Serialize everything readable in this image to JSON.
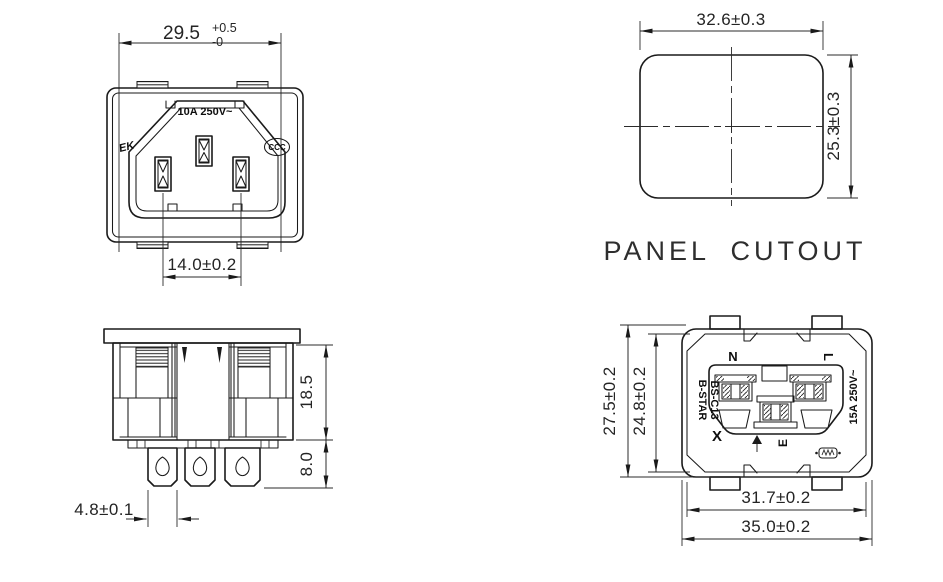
{
  "colors": {
    "line": "#1a1a1a",
    "background": "#ffffff",
    "dim_text": "#242424"
  },
  "front_view": {
    "marking_rating": "10A 250V~",
    "cert_left": "EK",
    "cert_right": "CCC",
    "dim_width_value": "29.5",
    "dim_width_tol_plus": "+0.5",
    "dim_width_tol_minus": "-0",
    "dim_pin_spacing": "14.0±0.2"
  },
  "panel_cutout": {
    "title": "PANEL CUTOUT",
    "dim_width": "32.6±0.3",
    "dim_height": "25.3±0.3"
  },
  "side_view": {
    "dim_body_height": "18.5",
    "dim_terminal_length": "8.0",
    "dim_terminal_width": "4.8±0.1"
  },
  "rear_view": {
    "label_n": "N",
    "label_l": "L",
    "label_e": "E",
    "brand": "B-STAR",
    "model": "BS-C13",
    "marking_rating": "15A 250V~",
    "mark_x": "X",
    "dim_height_outer": "27.5±0.2",
    "dim_height_inner": "24.8±0.2",
    "dim_width_inner": "31.7±0.2",
    "dim_width_outer": "35.0±0.2"
  }
}
